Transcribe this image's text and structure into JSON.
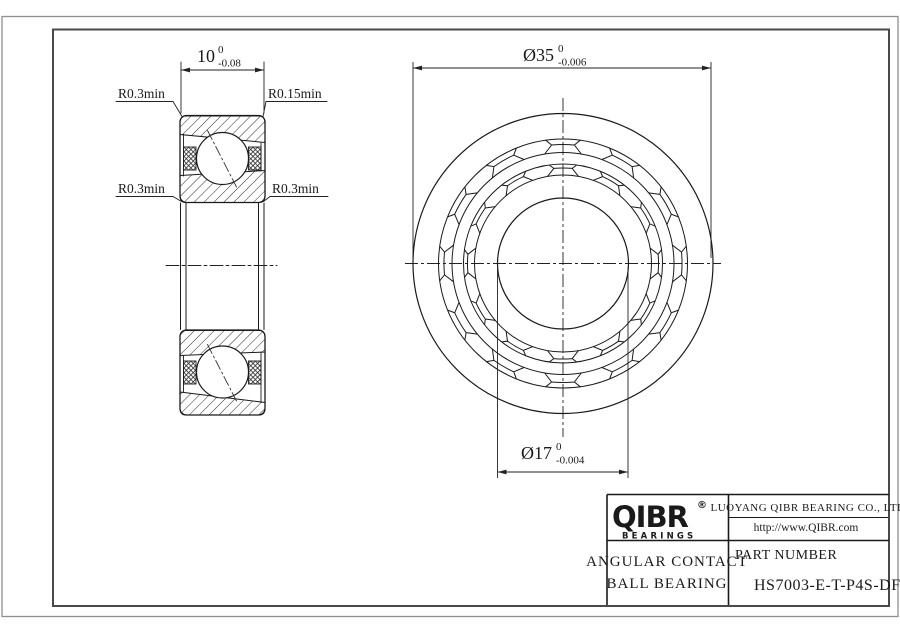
{
  "sheet": {
    "background": "#ffffff",
    "outer_border_color": "#8f8f8f",
    "frame_color": "#4a4a4a",
    "line_color": "#222222"
  },
  "section_view": {
    "width_dim": {
      "value": "10",
      "tol_upper": "0",
      "tol_lower": "-0.08"
    },
    "corner_labels": {
      "top_left": "R0.3min",
      "top_right": "R0.15min",
      "bottom_left": "R0.3min",
      "bottom_right": "R0.3min"
    }
  },
  "front_view": {
    "outer_dia_dim": {
      "value": "Ø35",
      "tol_upper": "0",
      "tol_lower": "-0.006"
    },
    "bore_dia_dim": {
      "value": "Ø17",
      "tol_upper": "0",
      "tol_lower": "-0.004"
    }
  },
  "title_block": {
    "logo": {
      "text": "QIBR",
      "registered": "®",
      "subtext": "BEARINGS"
    },
    "company": "LUOYANG QIBR BEARING CO., LTD",
    "website": "http://www.QIBR.com",
    "product": {
      "line1": "ANGULAR CONTACT",
      "line2": "BALL BEARING"
    },
    "part_number_label": "PART NUMBER",
    "part_number": "HS7003-E-T-P4S-DF"
  }
}
